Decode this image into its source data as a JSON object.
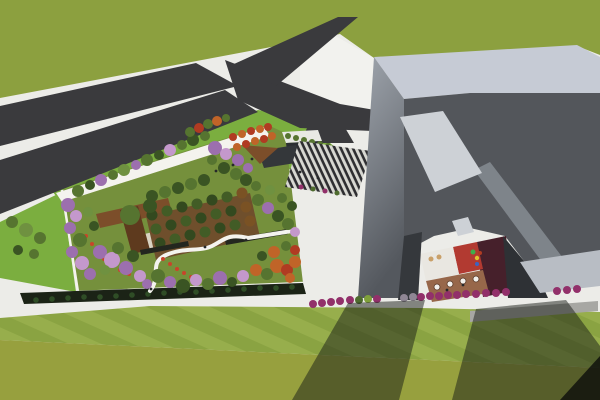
{
  "scene": {
    "description": "Aerial 3D architectural rendering: forked asphalt road on grass field, rooftop garden podium with mixed flowering trees and orchard, striped entry stairs, angular gray cultural building with terrace courtyard and playground, mowed lawns with long building shadows",
    "palette": {
      "concrete": "#ECECE8",
      "plazaWhite": "#F2F2EE",
      "grassField": "#8CA03F",
      "grassStripeA": "#97AE4C",
      "grassStripeB": "#8AA342",
      "grassRough": "#97A03E",
      "road": "#3A3A3D",
      "lawnBright": "#7BAE3F",
      "gardenLawn": "#75903C",
      "pathWhite": "#F4F3EE",
      "orchardSoil": "#6F4F2C",
      "deckBrown": "#7C4E2A",
      "deckDark": "#5E3A1E",
      "courtFloor": "#D9D3C2",
      "benchDark": "#23261F",
      "hedgeDark": "#1B2316",
      "kioskRoof": "#E9E9E4",
      "kioskDark": "#2C2F32",
      "pavilion": "#34373A",
      "bandLight": "#C6CBD5",
      "wallGradTop": "#A0A6AE",
      "wallGradBottom": "#54585E",
      "roofDark": "#53565B",
      "roofFacet": "#7E848A",
      "skylight": "#CDD1D6",
      "wallLow": "#B8BDC4",
      "wallDark": "#35383C",
      "wallDeep": "#2E3135",
      "courtWhite": "#E9E7E1",
      "courtRed": "#B23A31",
      "courtMaroon": "#46202B",
      "terraceBrown": "#97674A",
      "grayPath": "#A7A7A3",
      "stripeDark": "#2E2E31",
      "stripeLight": "#D8D8D2",
      "shadow": "rgba(24,27,22,0.5)",
      "shadowDeep": "rgba(10,12,10,0.78)",
      "gd": "#3A5423",
      "gm": "#567430",
      "gl": "#6F9140",
      "pu": "#9C6FAE",
      "pl": "#C498CC",
      "or": "#C06428",
      "rd": "#B03B22",
      "fr": "#C8452A",
      "od": "#33491F",
      "om": "#425C26",
      "ob": "#7A5224",
      "hg": "#2F4D26",
      "mg": "#92306A",
      "gn": "#4E6B2E",
      "yg": "#7FA03A",
      "gy": "#8F8694",
      "pe": "#26282A",
      "tw": "#F2F0EC",
      "wd": "#5A3B2A",
      "lt": "#C9A068",
      "pg": "#3FAE4A",
      "py": "#E0C22E",
      "pb": "#3C63C0"
    },
    "wedgeTrees": [
      [
        12,
        222,
        6,
        "gm"
      ],
      [
        26,
        230,
        7,
        "gl"
      ],
      [
        40,
        238,
        6,
        "gm"
      ],
      [
        18,
        250,
        5,
        "gd"
      ],
      [
        34,
        254,
        5,
        "gm"
      ]
    ],
    "hedges": [
      [
        36,
        300,
        2.8,
        "hg"
      ],
      [
        52,
        299,
        2.8,
        "hg"
      ],
      [
        68,
        298,
        2.8,
        "hg"
      ],
      [
        84,
        297,
        2.8,
        "hg"
      ],
      [
        100,
        297,
        2.8,
        "hg"
      ],
      [
        116,
        296,
        2.8,
        "hg"
      ],
      [
        132,
        295,
        2.8,
        "hg"
      ],
      [
        148,
        294,
        2.8,
        "hg"
      ],
      [
        164,
        293,
        2.8,
        "hg"
      ],
      [
        180,
        292,
        2.8,
        "hg"
      ],
      [
        196,
        292,
        2.8,
        "hg"
      ],
      [
        212,
        291,
        2.8,
        "hg"
      ],
      [
        228,
        290,
        2.8,
        "hg"
      ],
      [
        244,
        289,
        2.8,
        "hg"
      ],
      [
        260,
        288,
        2.8,
        "hg"
      ],
      [
        276,
        288,
        2.8,
        "hg"
      ],
      [
        292,
        287,
        2.8,
        "hg"
      ]
    ],
    "orchard": [
      [
        152,
        215,
        5.5,
        "od"
      ],
      [
        167,
        211,
        5.5,
        "om"
      ],
      [
        182,
        207,
        5.5,
        "od"
      ],
      [
        197,
        204,
        5.5,
        "om"
      ],
      [
        212,
        200,
        5.5,
        "od"
      ],
      [
        227,
        197,
        5.5,
        "om"
      ],
      [
        242,
        193,
        5.5,
        "ob"
      ],
      [
        156,
        229,
        5.5,
        "om"
      ],
      [
        171,
        225,
        5.5,
        "od"
      ],
      [
        186,
        221,
        5.5,
        "om"
      ],
      [
        201,
        218,
        5.5,
        "od"
      ],
      [
        216,
        214,
        5.5,
        "om"
      ],
      [
        231,
        211,
        5.5,
        "od"
      ],
      [
        246,
        207,
        5.5,
        "ob"
      ],
      [
        160,
        243,
        5.5,
        "od"
      ],
      [
        175,
        239,
        5.5,
        "om"
      ],
      [
        190,
        235,
        5.5,
        "od"
      ],
      [
        205,
        232,
        5.5,
        "om"
      ],
      [
        220,
        228,
        5.5,
        "od"
      ],
      [
        235,
        225,
        5.5,
        "om"
      ],
      [
        250,
        221,
        5.5,
        "ob"
      ]
    ],
    "flowers": [
      [
        86,
        236,
        2,
        "fr"
      ],
      [
        92,
        244,
        2,
        "fr"
      ],
      [
        98,
        252,
        2,
        "fr"
      ],
      [
        104,
        259,
        2,
        "fr"
      ],
      [
        112,
        265,
        2,
        "fr"
      ],
      [
        120,
        270,
        2,
        "fr"
      ],
      [
        129,
        274,
        2,
        "fr"
      ],
      [
        138,
        277,
        2,
        "fr"
      ],
      [
        163,
        259,
        2,
        "fr"
      ],
      [
        170,
        264,
        2,
        "fr"
      ],
      [
        177,
        269,
        2,
        "fr"
      ],
      [
        184,
        273,
        2,
        "fr"
      ],
      [
        191,
        277,
        2,
        "fr"
      ]
    ],
    "trees": [
      [
        78,
        191,
        6,
        "gm"
      ],
      [
        90,
        185,
        5,
        "gd"
      ],
      [
        101,
        180,
        6,
        "pu"
      ],
      [
        113,
        175,
        5,
        "gm"
      ],
      [
        124,
        170,
        6,
        "gl"
      ],
      [
        136,
        165,
        5,
        "pu"
      ],
      [
        147,
        160,
        6,
        "gm"
      ],
      [
        159,
        155,
        5,
        "gd"
      ],
      [
        170,
        150,
        6,
        "pl"
      ],
      [
        182,
        145,
        5,
        "gm"
      ],
      [
        193,
        140,
        6,
        "gd"
      ],
      [
        205,
        136,
        5,
        "gm"
      ],
      [
        215,
        148,
        7,
        "pu"
      ],
      [
        226,
        154,
        6,
        "pl"
      ],
      [
        238,
        160,
        6,
        "pu"
      ],
      [
        212,
        160,
        5,
        "gm"
      ],
      [
        224,
        168,
        6,
        "gd"
      ],
      [
        236,
        174,
        6,
        "gm"
      ],
      [
        248,
        168,
        5,
        "pu"
      ],
      [
        246,
        180,
        6,
        "gd"
      ],
      [
        256,
        186,
        5,
        "gm"
      ],
      [
        152,
        196,
        6,
        "gd"
      ],
      [
        165,
        192,
        6,
        "gm"
      ],
      [
        178,
        188,
        6,
        "gd"
      ],
      [
        191,
        184,
        6,
        "gm"
      ],
      [
        204,
        180,
        6,
        "gd"
      ],
      [
        68,
        205,
        7,
        "pu"
      ],
      [
        76,
        216,
        6,
        "pl"
      ],
      [
        70,
        228,
        6,
        "pu"
      ],
      [
        80,
        240,
        7,
        "gm"
      ],
      [
        72,
        252,
        6,
        "pu"
      ],
      [
        82,
        263,
        7,
        "pl"
      ],
      [
        90,
        274,
        6,
        "pu"
      ],
      [
        94,
        226,
        5,
        "gd"
      ],
      [
        88,
        212,
        5,
        "gl"
      ],
      [
        100,
        252,
        7,
        "pu"
      ],
      [
        112,
        260,
        8,
        "pl"
      ],
      [
        126,
        268,
        7,
        "pu"
      ],
      [
        140,
        276,
        6,
        "pl"
      ],
      [
        118,
        248,
        6,
        "gm"
      ],
      [
        133,
        256,
        6,
        "gd"
      ],
      [
        105,
        270,
        5,
        "gl"
      ],
      [
        147,
        284,
        5,
        "pu"
      ],
      [
        158,
        276,
        7,
        "gm"
      ],
      [
        170,
        282,
        6,
        "pu"
      ],
      [
        183,
        286,
        7,
        "gd"
      ],
      [
        196,
        280,
        6,
        "pl"
      ],
      [
        208,
        284,
        6,
        "gm"
      ],
      [
        220,
        278,
        7,
        "pu"
      ],
      [
        232,
        282,
        5,
        "gd"
      ],
      [
        243,
        276,
        6,
        "pl"
      ],
      [
        258,
        200,
        6,
        "gm"
      ],
      [
        268,
        208,
        6,
        "pu"
      ],
      [
        278,
        216,
        6,
        "gd"
      ],
      [
        288,
        224,
        6,
        "gm"
      ],
      [
        295,
        232,
        5,
        "pl"
      ],
      [
        270,
        190,
        5,
        "gl"
      ],
      [
        282,
        198,
        5,
        "gm"
      ],
      [
        292,
        206,
        5,
        "gd"
      ],
      [
        256,
        270,
        6,
        "or"
      ],
      [
        267,
        274,
        6,
        "gm"
      ],
      [
        277,
        266,
        7,
        "or"
      ],
      [
        287,
        270,
        6,
        "rd"
      ],
      [
        295,
        262,
        6,
        "or"
      ],
      [
        262,
        256,
        5,
        "gd"
      ],
      [
        274,
        252,
        6,
        "or"
      ],
      [
        286,
        246,
        5,
        "gm"
      ],
      [
        295,
        250,
        5,
        "rd"
      ],
      [
        290,
        278,
        5,
        "or"
      ],
      [
        130,
        215,
        10,
        "gm"
      ],
      [
        150,
        206,
        7,
        "gd"
      ]
    ],
    "plazaTrees": [
      [
        233,
        137,
        4,
        "rd"
      ],
      [
        242,
        134,
        4,
        "or"
      ],
      [
        251,
        131,
        4,
        "rd"
      ],
      [
        260,
        129,
        4,
        "or"
      ],
      [
        268,
        127,
        4,
        "rd"
      ],
      [
        237,
        147,
        4,
        "or"
      ],
      [
        246,
        144,
        4,
        "rd"
      ],
      [
        255,
        141,
        4,
        "or"
      ],
      [
        264,
        139,
        4,
        "rd"
      ],
      [
        272,
        136,
        4,
        "or"
      ],
      [
        190,
        132,
        5,
        "gm"
      ],
      [
        199,
        128,
        5,
        "rd"
      ],
      [
        208,
        124,
        5,
        "gm"
      ],
      [
        217,
        121,
        5,
        "or"
      ],
      [
        226,
        118,
        4,
        "gm"
      ],
      [
        288,
        136,
        3,
        "gm"
      ],
      [
        296,
        138,
        3,
        "gm"
      ],
      [
        304,
        140,
        3,
        "gm"
      ],
      [
        312,
        142,
        3,
        "gm"
      ],
      [
        320,
        144,
        3,
        "gm"
      ],
      [
        328,
        146,
        3,
        "gm"
      ]
    ],
    "boxes": [
      [
        301,
        187,
        2.5,
        "mg"
      ],
      [
        313,
        189,
        2.5,
        "gn"
      ],
      [
        325,
        191,
        2.5,
        "mg"
      ],
      [
        337,
        193,
        2.5,
        "gn"
      ]
    ],
    "shrubs": [
      [
        313,
        304,
        4,
        "mg"
      ],
      [
        322,
        303,
        4,
        "mg"
      ],
      [
        331,
        302,
        4,
        "mg"
      ],
      [
        340,
        301,
        4,
        "mg"
      ],
      [
        350,
        300,
        4,
        "mg"
      ],
      [
        359,
        300,
        4,
        "gn"
      ],
      [
        368,
        299,
        4,
        "yg"
      ],
      [
        377,
        299,
        4,
        "mg"
      ],
      [
        404,
        298,
        4,
        "gy"
      ],
      [
        413,
        297,
        4,
        "gy"
      ],
      [
        421,
        297,
        4,
        "mg"
      ],
      [
        430,
        296,
        4,
        "mg"
      ],
      [
        439,
        296,
        4,
        "mg"
      ],
      [
        448,
        295,
        4,
        "mg"
      ],
      [
        457,
        295,
        4,
        "mg"
      ],
      [
        466,
        294,
        4,
        "mg"
      ],
      [
        476,
        294,
        4,
        "mg"
      ],
      [
        486,
        293,
        4,
        "mg"
      ],
      [
        496,
        293,
        4,
        "mg"
      ],
      [
        506,
        292,
        4,
        "mg"
      ],
      [
        557,
        291,
        4,
        "mg"
      ],
      [
        567,
        290,
        4,
        "mg"
      ],
      [
        577,
        289,
        4,
        "mg"
      ]
    ],
    "tables": [
      [
        437,
        287,
        3,
        "tw",
        "wd"
      ],
      [
        450,
        284,
        3,
        "tw",
        "wd"
      ],
      [
        463,
        281,
        3,
        "tw",
        "wd"
      ],
      [
        476,
        279,
        3,
        "tw",
        "wd"
      ]
    ],
    "loungers": [
      [
        431,
        259,
        2.5,
        "lt"
      ],
      [
        439,
        257,
        2.5,
        "lt"
      ]
    ],
    "play": [
      [
        473,
        252,
        2.5,
        "pg"
      ],
      [
        477,
        258,
        2.2,
        "py"
      ],
      [
        480,
        253,
        2,
        "rd"
      ],
      [
        477,
        264,
        2,
        "pb"
      ]
    ],
    "people": [
      [
        216,
        171,
        1.4,
        "pe"
      ],
      [
        233,
        165,
        1.4,
        "pe"
      ],
      [
        252,
        159,
        1.4,
        "pe"
      ],
      [
        300,
        172,
        1.4,
        "pe"
      ],
      [
        318,
        178,
        1.4,
        "pe"
      ],
      [
        205,
        247,
        1.4,
        "pe"
      ],
      [
        246,
        240,
        1.4,
        "pe"
      ],
      [
        151,
        289,
        1.4,
        "pe"
      ],
      [
        447,
        290,
        1.4,
        "pe"
      ],
      [
        463,
        285,
        1.4,
        "pe"
      ]
    ]
  }
}
